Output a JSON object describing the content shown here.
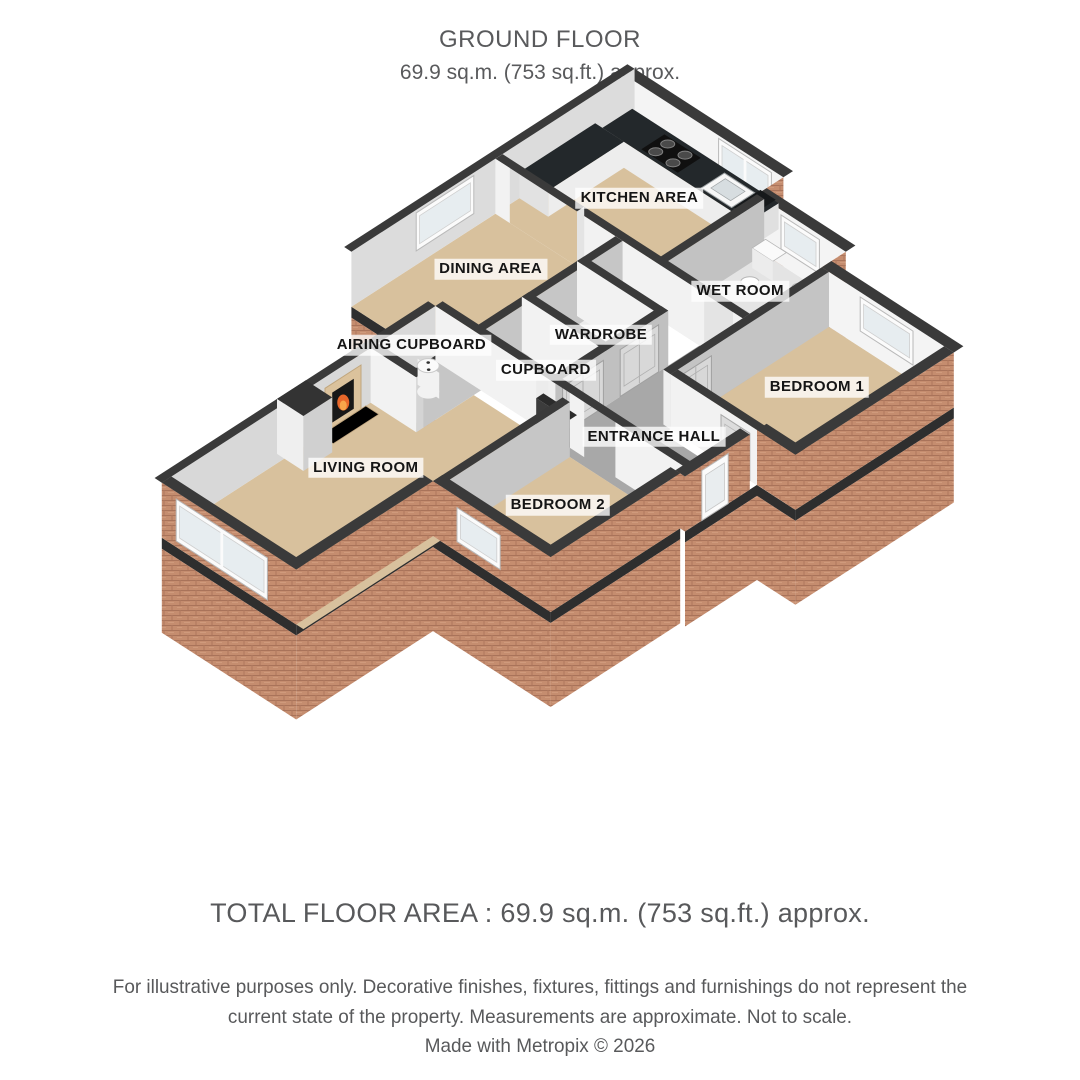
{
  "header": {
    "title": "GROUND FLOOR",
    "subtitle": "69.9 sq.m. (753 sq.ft.) approx."
  },
  "floorplan": {
    "rooms": [
      {
        "id": "kitchen",
        "label": "KITCHEN AREA"
      },
      {
        "id": "dining",
        "label": "DINING AREA"
      },
      {
        "id": "wetroom",
        "label": "WET ROOM"
      },
      {
        "id": "airing",
        "label": "AIRING CUPBOARD"
      },
      {
        "id": "wardrobe",
        "label": "WARDROBE"
      },
      {
        "id": "cupboard",
        "label": "CUPBOARD"
      },
      {
        "id": "bedroom1",
        "label": "BEDROOM 1"
      },
      {
        "id": "living",
        "label": "LIVING ROOM"
      },
      {
        "id": "hall",
        "label": "ENTRANCE HALL"
      },
      {
        "id": "bedroom2",
        "label": "BEDROOM 2"
      }
    ],
    "colors": {
      "wall_top": "#3a3a3a",
      "wall_interior_bright": "#f2f2f2",
      "wall_interior_shaded": "#c4c4c4",
      "floor_room": "#d8c19d",
      "floor_hall": "#a8a8a8",
      "floor_wet": "#e4e4e4",
      "floor_closet": "#ececec",
      "brick": "#c58d6f",
      "brick_line": "#a9735a",
      "counter_top": "#23282b",
      "glass": "#e7edf0",
      "fire": "#e8672a"
    }
  },
  "footer": {
    "total": "TOTAL FLOOR AREA : 69.9 sq.m. (753 sq.ft.) approx.",
    "disclaimer": "For illustrative purposes only. Decorative finishes, fixtures, fittings and furnishings do not represent the current state of the property. Measurements are approximate. Not to scale.",
    "credit": "Made with Metropix © 2026"
  }
}
